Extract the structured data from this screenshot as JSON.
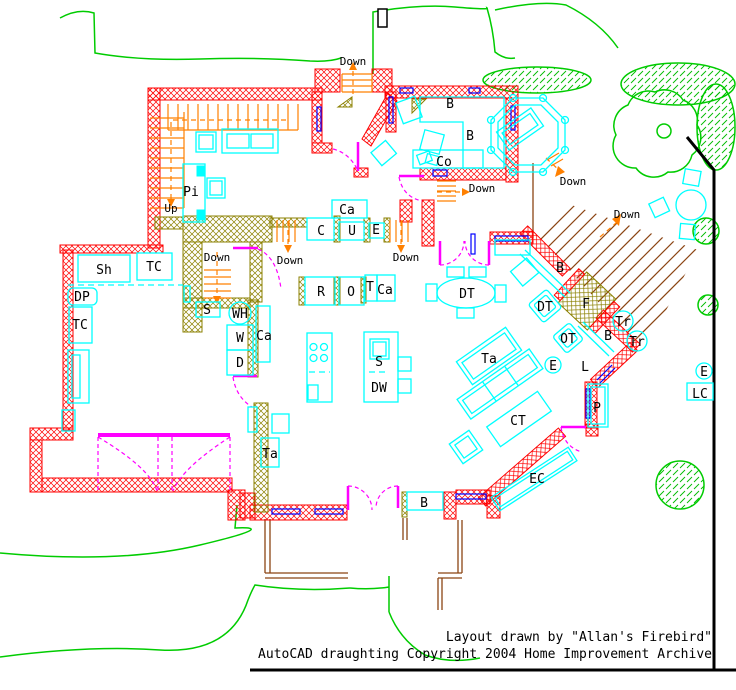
{
  "drawing": {
    "type": "floor-plan",
    "software": "AutoCAD"
  },
  "colors": {
    "exterior_wall": "#ff0000",
    "interior_wall": "#8b8000",
    "stairs": "#ff8000",
    "furniture": "#00ffff",
    "doors": "#ff00ff",
    "windows": "#0000ff",
    "landscaping": "#00cc00",
    "deck": "#8b4513",
    "property_line": "#000000"
  },
  "labels": {
    "down": "Down",
    "up": "Up",
    "pi": "Pi",
    "sh": "Sh",
    "tc": "TC",
    "dp": "DP",
    "s": "S",
    "wh": "WH",
    "w": "W",
    "d": "D",
    "ca": "Ca",
    "c": "C",
    "u": "U",
    "e": "E",
    "r": "R",
    "o": "O",
    "t": "T",
    "dw": "DW",
    "b": "B",
    "co": "Co",
    "dt": "DT",
    "ot": "OT",
    "f": "F",
    "tr": "Tr",
    "ta": "Ta",
    "l": "L",
    "ct": "CT",
    "ec": "EC",
    "p": "P",
    "lc": "LC"
  },
  "footer": {
    "line1": "Layout drawn by \"Allan's Firebird\"",
    "line2": "AutoCAD draughting Copyright 2004 Home Improvement Archive"
  }
}
